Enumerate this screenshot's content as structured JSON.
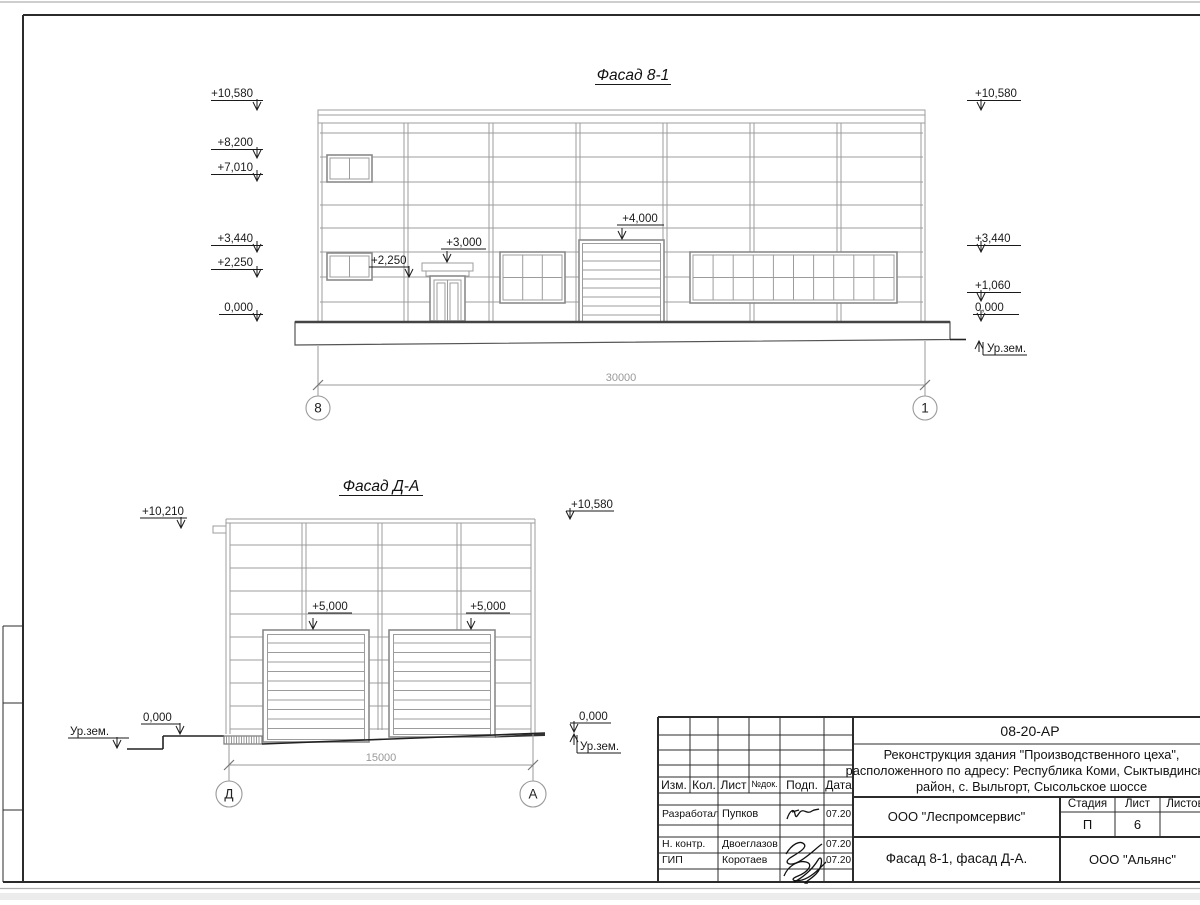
{
  "colors": {
    "drawing_line": "#9c9c9c",
    "annotation_text": "#1a1a1a",
    "dimension_gray": "#999999",
    "frame_black": "#2b2b2b",
    "sheet_white": "#ffffff"
  },
  "facade1": {
    "title": "Фасад 8-1",
    "left_marks": [
      "+10,580",
      "+8,200",
      "+7,010",
      "+3,440",
      "+2,250",
      "0,000"
    ],
    "right_marks": [
      "+10,580",
      "+3,440",
      "+1,060",
      "0,000"
    ],
    "ground_label": "Ур.зем.",
    "door_canopy_mark": "+3,000",
    "door_side_mark": "+2,250",
    "gate_mark": "+4,000",
    "dimension": "30000",
    "axis_left": "8",
    "axis_right": "1"
  },
  "facade2": {
    "title": "Фасад Д-А",
    "left_mark": "+10,210",
    "right_mark": "+10,580",
    "gate_marks": [
      "+5,000",
      "+5,000"
    ],
    "zero_left": "0,000",
    "zero_right": "0,000",
    "ground_left": "Ур.зем.",
    "ground_right": "Ур.зем.",
    "dimension": "15000",
    "axis_left": "Д",
    "axis_right": "А"
  },
  "titleblock": {
    "doc_number": "08-20-АР",
    "project_line1": "Реконструкция здания \"Производственного цеха\",",
    "project_line2": "расположенного по адресу: Республика Коми, Сыктывдинский",
    "project_line3": "район, с. Выльгорт, Сысольское шоссе",
    "rev_headers": [
      "Изм.",
      "Кол.",
      "Лист",
      "№док.",
      "Подп.",
      "Дата"
    ],
    "rows": [
      {
        "role": "Разработал",
        "name": "Пупков",
        "date": "07.20"
      },
      {
        "role": "Н. контр.",
        "name": "Двоеглазов",
        "date": "07.20"
      },
      {
        "role": "ГИП",
        "name": "Коротаев",
        "date": "07.20"
      }
    ],
    "org1": "ООО \"Леспромсервис\"",
    "subject": "Фасад 8-1, фасад Д-А.",
    "stage_header": [
      "Стадия",
      "Лист",
      "Листов"
    ],
    "stage_value": "П",
    "sheet_value": "6",
    "org2": "ООО \"Альянс\""
  }
}
